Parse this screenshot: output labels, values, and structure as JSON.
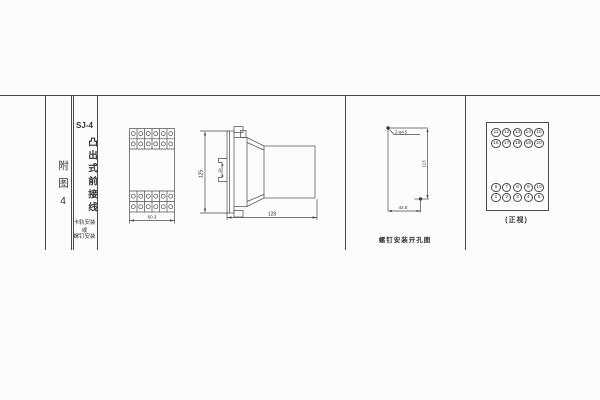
{
  "title_block": {
    "figure_label": "附图4",
    "model": "SJ-4",
    "type_text": "凸出式前接线",
    "mount_text_line1": "卡轨安装",
    "mount_text_line2": "或",
    "mount_text_line3": "螺钉安装"
  },
  "front_view": {
    "width_dim": "60.3"
  },
  "side_view": {
    "height_dim": "125",
    "clip_dim": "35",
    "depth_dim": "128"
  },
  "mounting_view": {
    "holes_label": "2-φ4.5",
    "height_dim": "113",
    "width_dim": "44.5",
    "caption": "螺钉安装开孔图"
  },
  "terminal_view": {
    "caption": "(正视)",
    "rows": [
      [
        "11",
        "12",
        "13",
        "14",
        "15"
      ],
      [
        "16",
        "17",
        "18",
        "19",
        "20"
      ],
      [
        "6",
        "7",
        "8",
        "9",
        "10"
      ],
      [
        "1",
        "2",
        "3",
        "4",
        "5"
      ]
    ]
  }
}
